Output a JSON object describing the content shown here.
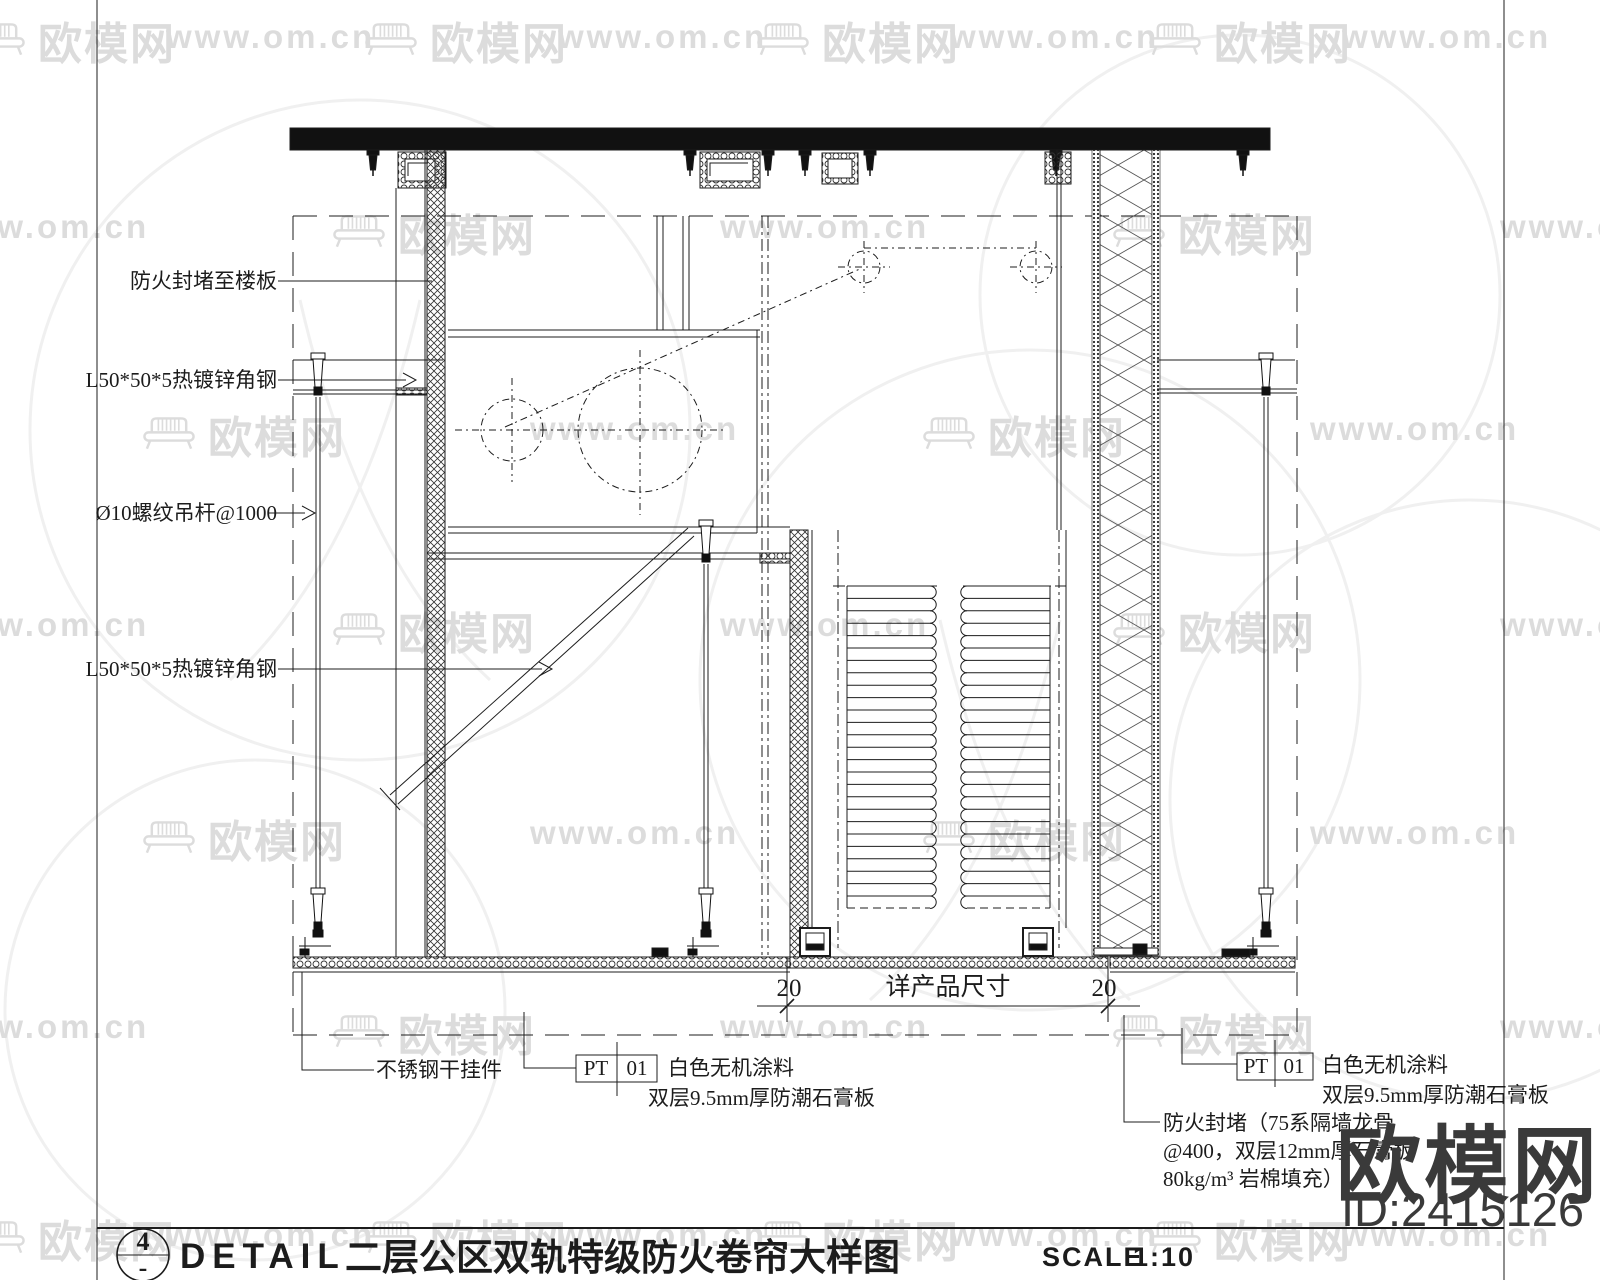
{
  "watermark": {
    "url_text": "www.om.cn",
    "brand_text": "欧模网",
    "site_id": "ID:2415126"
  },
  "annotations": {
    "seal_to_slab": "防火封堵至楼板",
    "angle_steel_top": "L50*50*5热镀锌角钢",
    "threaded_rod": "Ø10螺纹吊杆@1000",
    "angle_steel_brace": "L50*50*5热镀锌角钢",
    "stainless_hanger": "不锈钢干挂件",
    "finish_left": {
      "code": "PT",
      "number": "01",
      "line1": "白色无机涂料",
      "line2": "双层9.5mm厚防潮石膏板"
    },
    "finish_right": {
      "code": "PT",
      "number": "01",
      "line1": "白色无机涂料",
      "line2": "双层9.5mm厚防潮石膏板"
    },
    "fire_seal_note": {
      "line1": "防火封堵（75系隔墙龙骨",
      "line2": "@400，双层12mm厚石膏板",
      "line3": "80kg/m³ 岩棉填充）"
    }
  },
  "dimension": {
    "left": "20",
    "center": "详产品尺寸",
    "right": "20"
  },
  "title_bar": {
    "bubble_number": "4",
    "bubble_suffix": "-",
    "detail_label": "DETAIL",
    "drawing_name": "二层公区双轨特级防火卷帘大样图",
    "scale_label": "SCALE",
    "scale_value": "1:10"
  },
  "colors": {
    "line": "#1c1c1c",
    "watermark_light": "#dcdcdc",
    "watermark_dark": "#3a3a3a"
  }
}
